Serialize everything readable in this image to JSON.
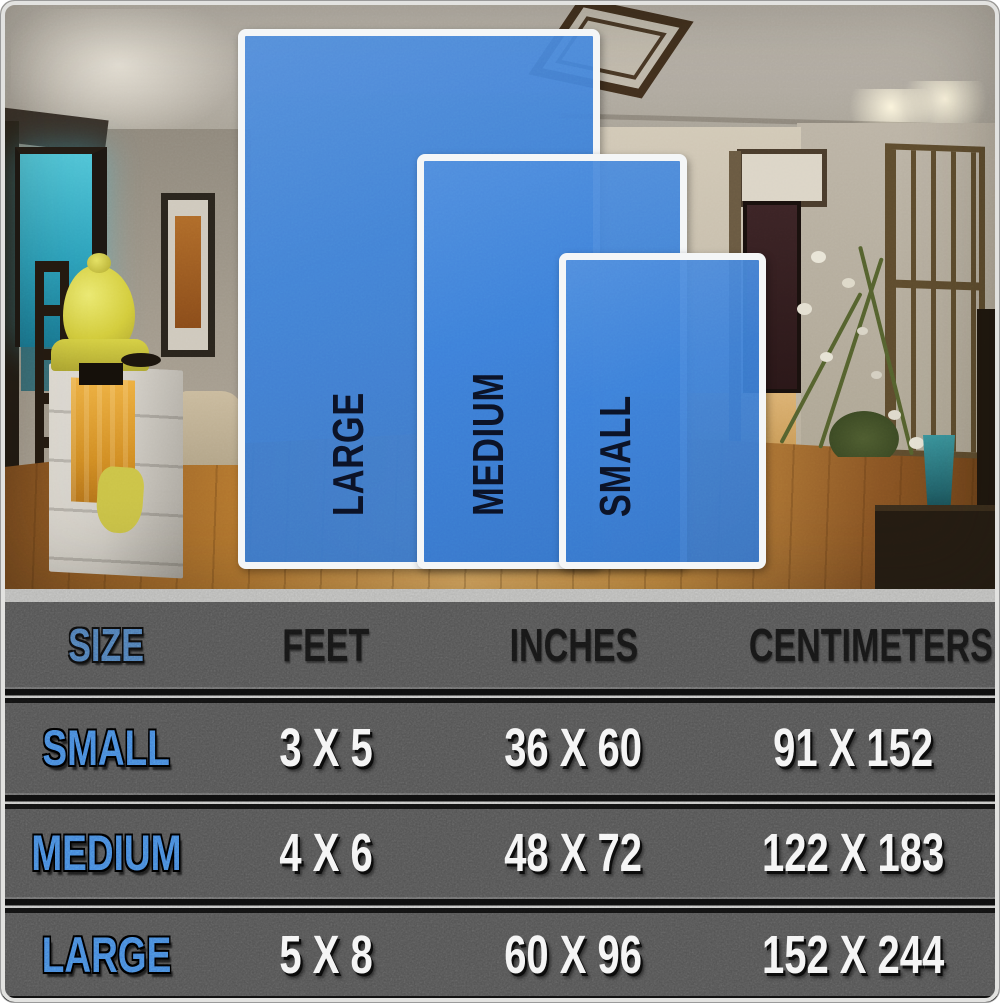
{
  "rug_preview": {
    "sizes": [
      {
        "id": "large",
        "label": "LARGE"
      },
      {
        "id": "medium",
        "label": "MEDIUM"
      },
      {
        "id": "small",
        "label": "SMALL"
      }
    ]
  },
  "size_table": {
    "columns": [
      "SIZE",
      "FEET",
      "INCHES",
      "CENTIMETERS"
    ],
    "rows": [
      {
        "size": "SMALL",
        "feet": "3 X 5",
        "inches": "36 X 60",
        "centimeters": "91 X 152"
      },
      {
        "size": "MEDIUM",
        "feet": "4 X 6",
        "inches": "48 X 72",
        "centimeters": "122 X 183"
      },
      {
        "size": "LARGE",
        "feet": "5 X 8",
        "inches": "60 X 96",
        "centimeters": "152 X 244"
      }
    ]
  },
  "colors": {
    "rug-blue": "#3e82da",
    "rug-label-navy": "#0b1226",
    "accent-blue": "#4583d8",
    "size-header-blue": "#4c79b4",
    "value-white": "#f4f4f4",
    "text-black": "#161616",
    "table-grey": "#535353",
    "separator-black": "#0e0e0e",
    "floor-wood": "#b5782f",
    "window-teal": "#2da2bc",
    "buddha-gold": "#d3cc3c"
  }
}
